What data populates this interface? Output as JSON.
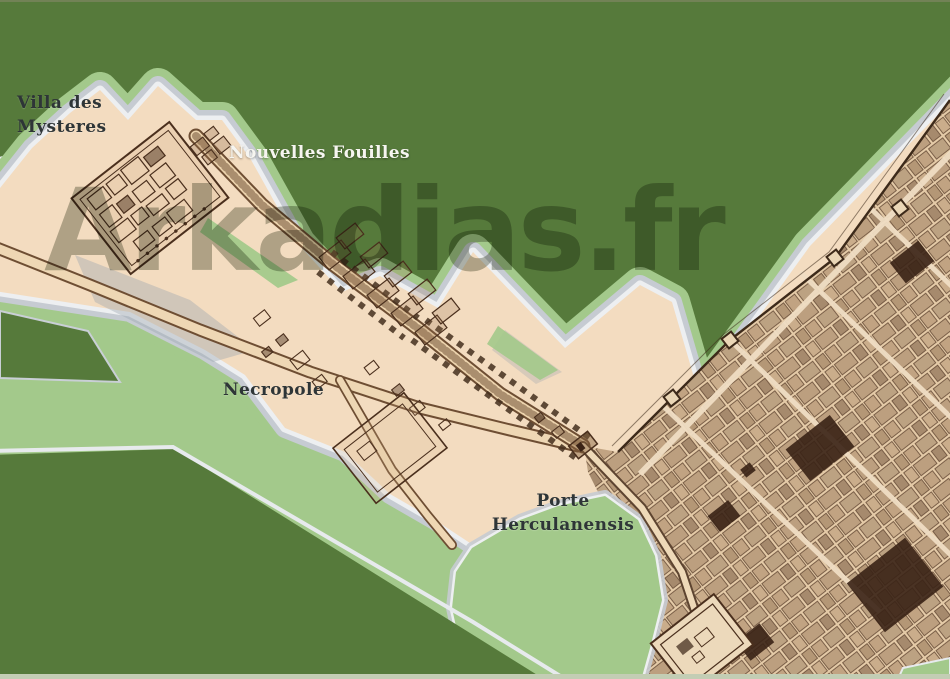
{
  "watermark": {
    "text": "Arkadias.fr"
  },
  "map": {
    "title": "Plan de Pompei - quartier de la Porte d'Herculanum",
    "labels": [
      {
        "id": "villa-des-mysteres",
        "lines": [
          "Villa des",
          "Mysteres"
        ],
        "style": "dark"
      },
      {
        "id": "nouvelles-fouilles",
        "lines": [
          "Nouvelles Fouilles"
        ],
        "style": "light"
      },
      {
        "id": "necropole",
        "lines": [
          "Necropole"
        ],
        "style": "dark"
      },
      {
        "id": "porte-herculanensis",
        "lines": [
          "Porte",
          "Herculanensis"
        ],
        "style": "dark"
      }
    ]
  },
  "theme": {
    "bg_green": "#567a3b",
    "light_green": "#a3c98b",
    "shadow_gray": "#c6cbd2",
    "shadow_white": "#edeff1",
    "map_beige": "#f3dcc0",
    "city_sepia": "#e4caa7",
    "plan_ink": "#4a2f1d",
    "label_dark": "#2e3537",
    "label_light": "#f6f5f0",
    "watermark": "#b2b5ab",
    "border_strip": "#c3cdb4"
  }
}
